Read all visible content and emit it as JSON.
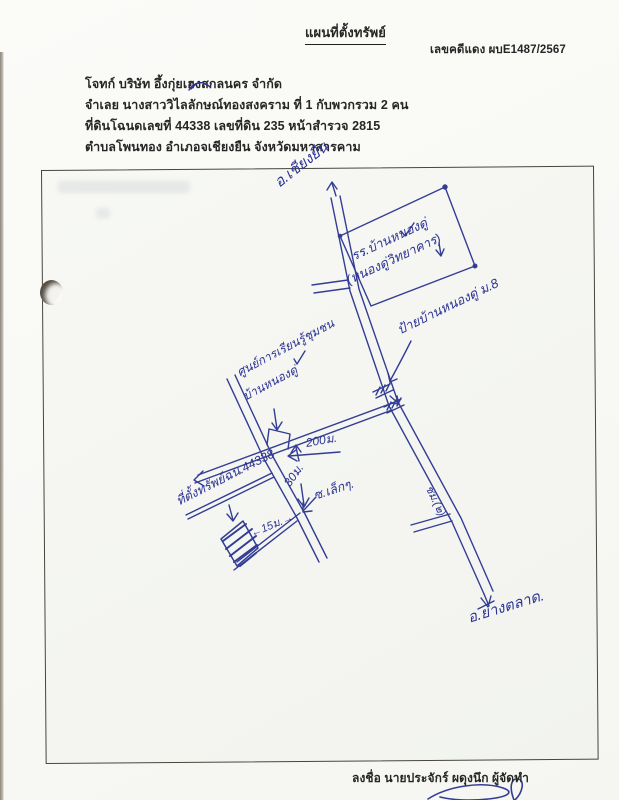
{
  "document": {
    "title": "แผนที่ตั้งทรัพย์",
    "case_number": "เลขคดีแดง ผบE1487/2567",
    "body_lines": [
      "โจทก์ บริษัท อึ้งกุ่ยเฮงสกลนคร จำกัด",
      "จำเลย นางสาววิไลลักษณ์ทองสงคราม  ที่ 1 กับพวกรวม 2 คน",
      "ที่ดินโฉนดเลขที่ 44338 เลขที่ดิน 235  หน้าสำรวจ 2815",
      "ตำบลโพนทอง  อำเภอจเชียงยืน  จังหวัดมหาสารคาม"
    ],
    "signer_line": "ลงชื่อ นายประจักร์ ผดุงนึก ผู้จัดทำ"
  },
  "map": {
    "destination_north": "อ.เชียงยืน",
    "destination_south": "อ.ยางตลาด.",
    "school_name_line1": "รร.บ้านหนองดู่",
    "school_name_line2": "(หนองดู่วิทยาคาร)",
    "village_sign": "ป้ายบ้านหนองดู่ ม.8",
    "learning_center_line1": "ศูนย์การเรียนรู้ชุมชน",
    "learning_center_line2": "บ้านหนองดู่",
    "property_label": "ที่ตั้งทรัพย์ฉน.44338",
    "frontage": "←15ม.→",
    "distance_main_to_cross": "200ม.",
    "distance_cross_to_soi": "30ม.",
    "small_soi": "ซ.เล็กๆ.",
    "road_note": "ชม.(๒)",
    "ink_color": "#333d94"
  }
}
